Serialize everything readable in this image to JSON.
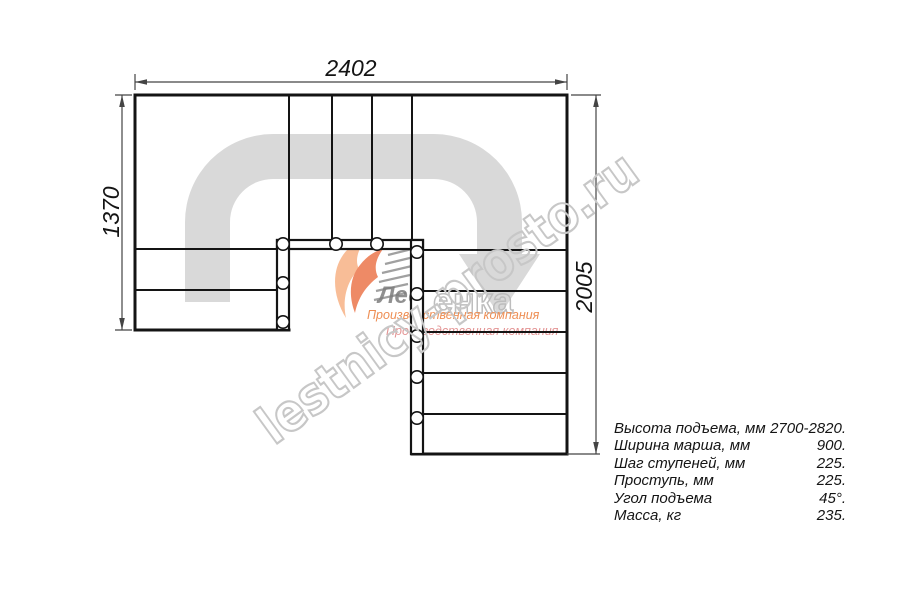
{
  "dimensions": {
    "width_label": "2402",
    "left_height_label": "1370",
    "right_height_label": "2005"
  },
  "watermark": {
    "text": "lestnicy-prosto.ru"
  },
  "logo": {
    "brand_dark": "Лес",
    "brand_outline": "енка",
    "tagline": "Производственная компания",
    "tagline_shadow": "Производственная компания"
  },
  "specs": {
    "rows": [
      {
        "label": "Высота подъема, мм",
        "value": "2700-2820."
      },
      {
        "label": "Ширина марша, мм",
        "value": "900."
      },
      {
        "label": "Шаг ступеней, мм",
        "value": "225."
      },
      {
        "label": "Проступь, мм",
        "value": "225."
      },
      {
        "label": "Угол подъема",
        "value": "45°."
      },
      {
        "label": "Масса, кг",
        "value": "235."
      }
    ]
  }
}
